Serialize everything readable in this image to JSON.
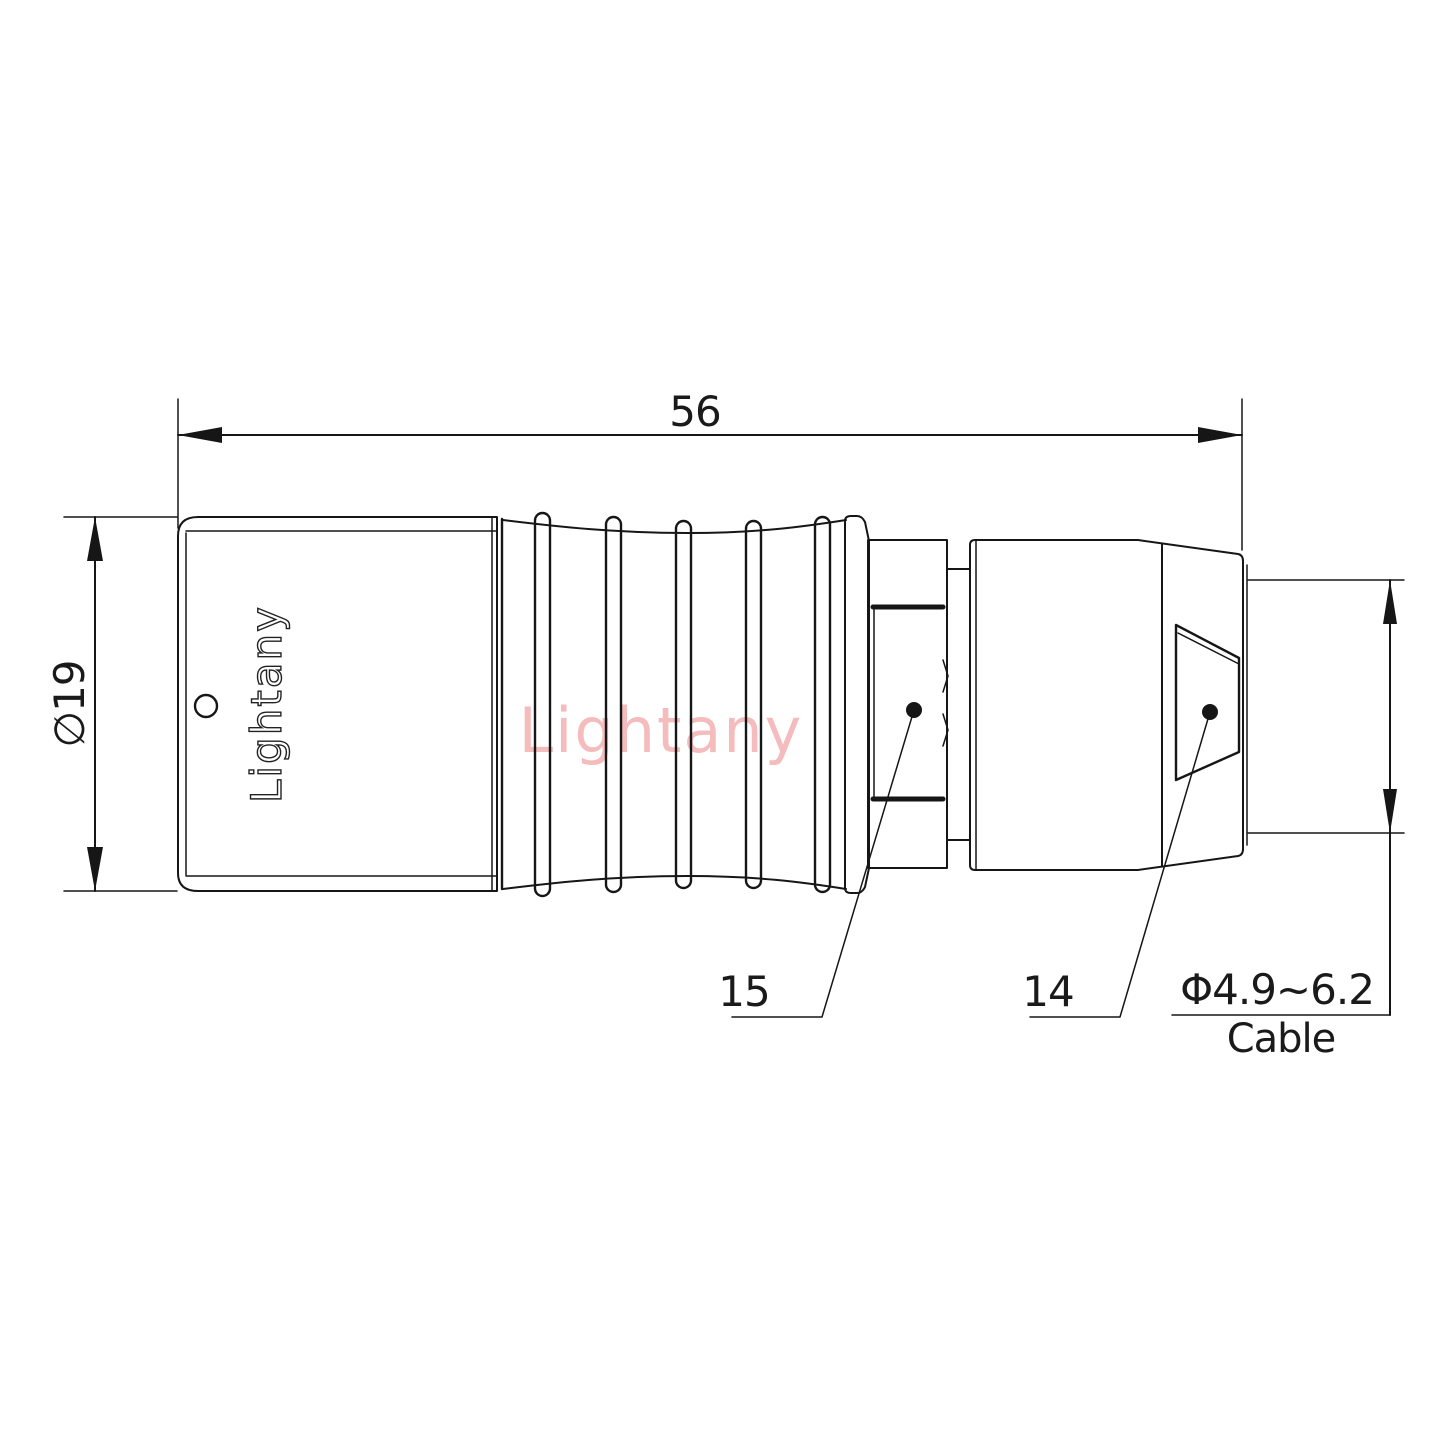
{
  "app": {
    "type": "technical-drawing",
    "background": "#ffffff",
    "line_color": "#161616"
  },
  "watermark": {
    "text": "Lightany",
    "color": "#f4bcbc"
  },
  "connector": {
    "brand_label": "Lightany",
    "part_labels": {
      "strain_relief_collar": "15",
      "back_nut": "14"
    }
  },
  "dimensions": {
    "total_length": "56",
    "outer_diameter": "∅19",
    "cable_diameter_range": "Φ4.9~6.2",
    "cable_label": "Cable"
  }
}
